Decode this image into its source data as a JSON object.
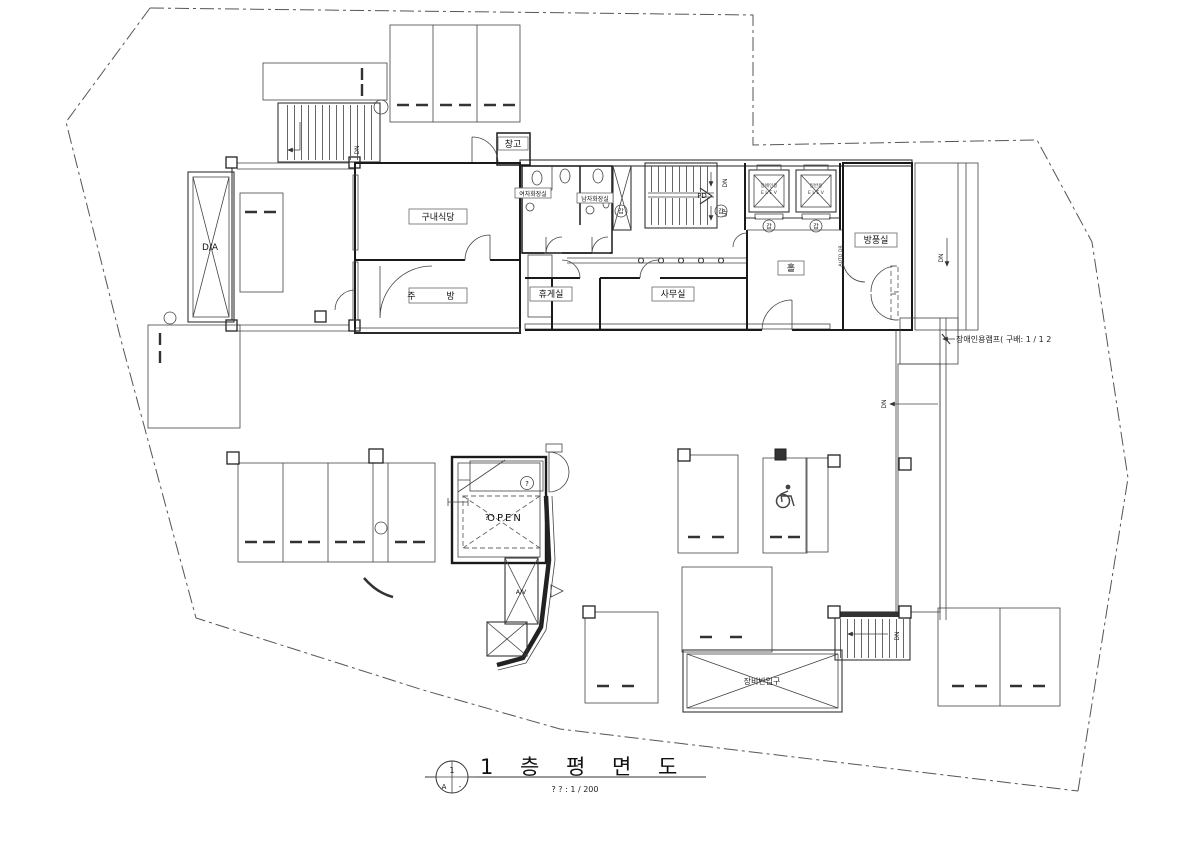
{
  "page": {
    "background": "#ffffff",
    "ink": "#1a1a1a"
  },
  "title_block": {
    "detail_number": "1",
    "sheet_ref": "A",
    "sheet_dash": "-",
    "drawing_title": "1 층 평 면 도",
    "scale_note": "? ? : 1 / 200"
  },
  "rooms": {
    "storage": "창고",
    "cafeteria": "구내식당",
    "kitchen": "주 방",
    "lounge": "휴게실",
    "office": "사무실",
    "hall": "홀",
    "vestibule": "방풍실",
    "womens_toilet": "여자화장실",
    "mens_toilet": "남자화장실"
  },
  "shafts": {
    "da": "D/A",
    "av": "A/V",
    "pd": "PD",
    "open_void": "OPEN"
  },
  "elevators": {
    "left_use": "장애인용",
    "right_use": "일반용",
    "car_label": "E L E V"
  },
  "stair_marks": {
    "up": "UP",
    "down": "DN"
  },
  "annotations": {
    "ramp_note": "장애인용램프( 구배: 1 / 1 2",
    "equipment_entrance": "장비반입구",
    "auto_door": "AUTO DR",
    "door_type_mark": "갑",
    "unknown_mark": "?"
  },
  "icons": {
    "wheelchair": "♿"
  }
}
